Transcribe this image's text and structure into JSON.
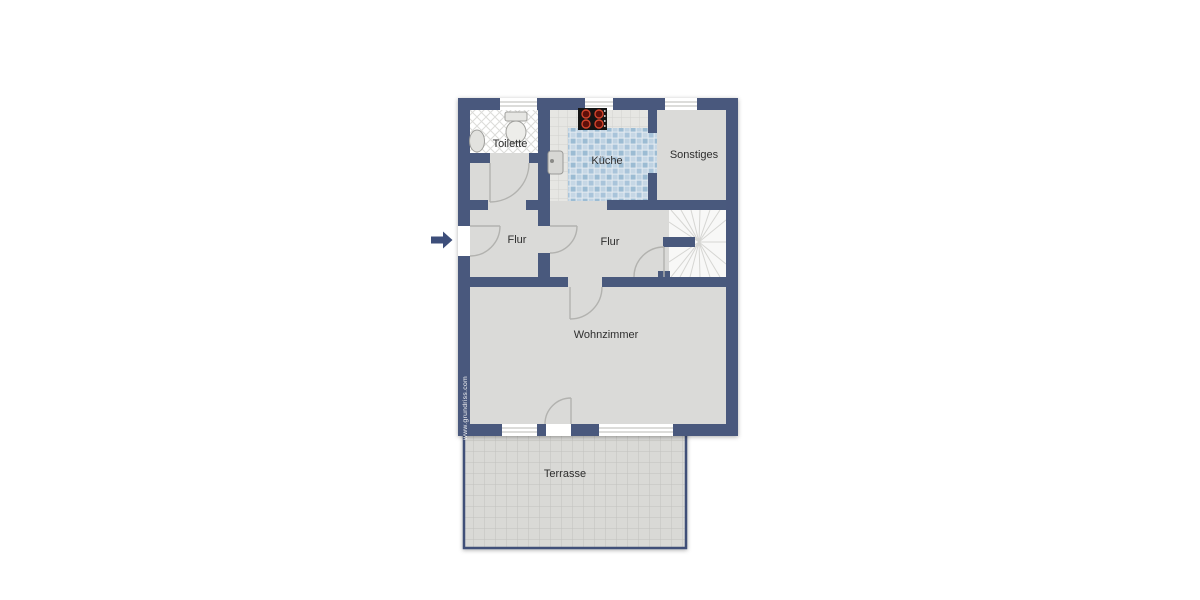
{
  "page": {
    "background": "#ffffff",
    "type": "floor-plan-drawing"
  },
  "floor_plan": {
    "rooms": [
      {
        "id": "toilette",
        "label": "Toilette"
      },
      {
        "id": "kueche",
        "label": "Küche"
      },
      {
        "id": "sonstiges",
        "label": "Sonstiges"
      },
      {
        "id": "flur_links",
        "label": "Flur"
      },
      {
        "id": "flur_mitte",
        "label": "Flur"
      },
      {
        "id": "wohnzimmer",
        "label": "Wohnzimmer"
      },
      {
        "id": "terrasse",
        "label": "Terrasse"
      }
    ],
    "watermark": "www.grundriss.com",
    "fixtures": [
      "toilet-icon",
      "washbasin-icon",
      "kitchen-sink-icon",
      "stove-icon",
      "staircase-icon",
      "entrance-arrow-icon",
      "door-swing-icon",
      "window-symbol-icon"
    ],
    "colors": {
      "wall": "#49597d",
      "floor": "#dadad8",
      "toilet_tile": "#ffffff",
      "kitchen_tile_dark": "#9cbcd3",
      "kitchen_tile_light": "#c6d7e5",
      "counter": "#e6e6e3",
      "stair_floor": "#f8f8f7",
      "terrace_floor": "#d9d9d6",
      "stove": "#141414",
      "burner_ring": "#d2442c",
      "door_arc": "#b2b2af",
      "label_text": "#2e2e2e",
      "arrow": "#3d4e7a",
      "watermark_text": "#f7f7f7"
    }
  }
}
